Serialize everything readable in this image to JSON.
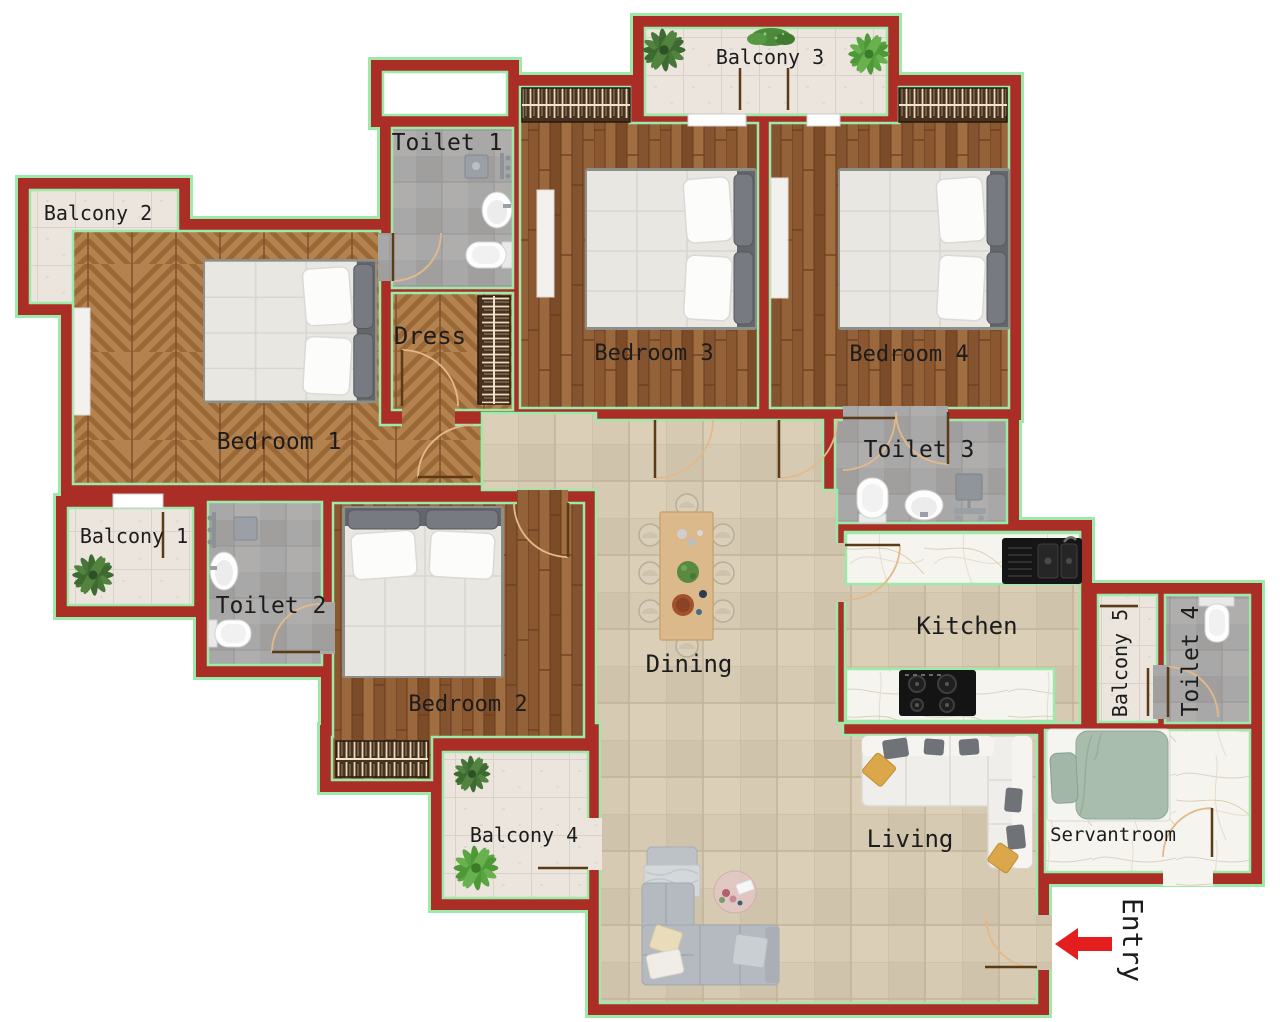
{
  "plan": {
    "title": "Apartment floor plan",
    "rooms": {
      "bedroom1": "Bedroom 1",
      "bedroom2": "Bedroom 2",
      "bedroom3": "Bedroom 3",
      "bedroom4": "Bedroom 4",
      "toilet1": "Toilet 1",
      "toilet2": "Toilet 2",
      "toilet3": "Toilet 3",
      "toilet4": "Toilet 4",
      "balcony1": "Balcony 1",
      "balcony2": "Balcony 2",
      "balcony3": "Balcony 3",
      "balcony4": "Balcony 4",
      "balcony5": "Balcony 5",
      "dress": "Dress",
      "kitchen": "Kitchen",
      "dining": "Dining",
      "living": "Living",
      "servantroom": "Servantroom"
    },
    "entry": {
      "label": "Entry"
    },
    "colors": {
      "wall": "#aa2d26",
      "wall_outline": "#9beaa9",
      "label_text": "#1c1c1c",
      "entry_arrow": "#e41e1e",
      "wood_plank": "#8e5c33",
      "wood_chevron": "#b4824e",
      "balcony_tile": "#ebe5dd",
      "toilet_tile": "#a8a8a8",
      "main_tile": "#d6cab3",
      "marble": "#f6f4ef",
      "door_arc": "#e3b98a"
    }
  }
}
